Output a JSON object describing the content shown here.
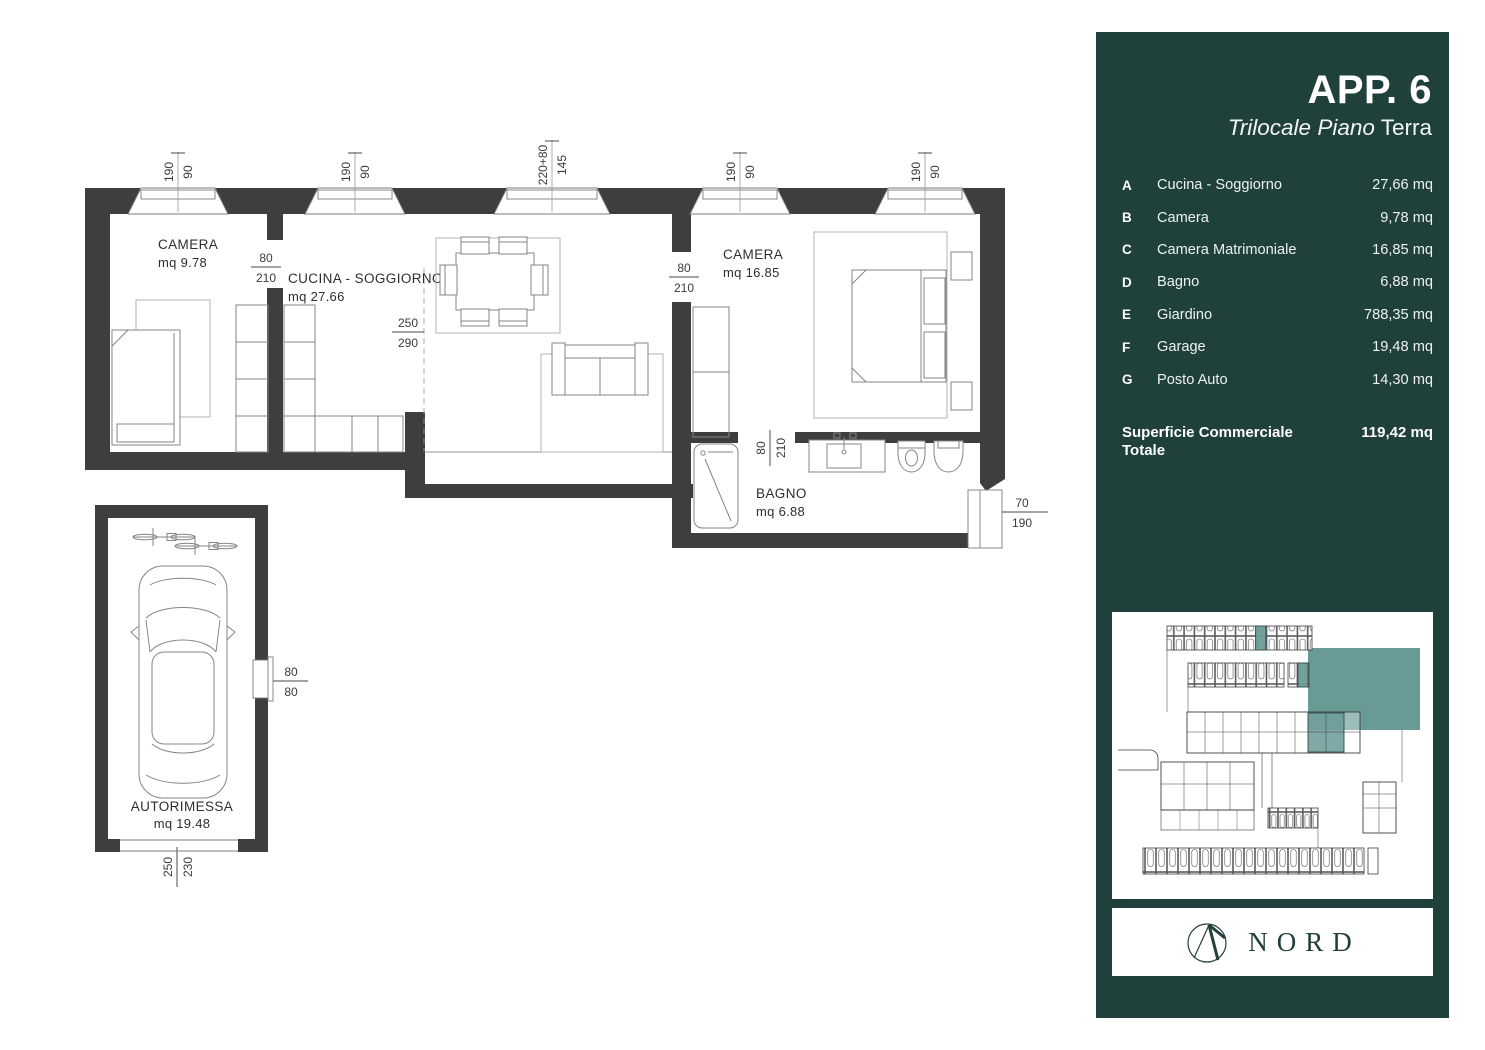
{
  "floorplan": {
    "rooms": {
      "camera1": {
        "name": "CAMERA",
        "area": "mq 9.78"
      },
      "cucina": {
        "name": "CUCINA - SOGGIORNO",
        "area": "mq 27.66"
      },
      "camera2": {
        "name": "CAMERA",
        "area": "mq 16.85"
      },
      "bagno": {
        "name": "BAGNO",
        "area": "mq 6.88"
      },
      "garage": {
        "name": "AUTORIMESSA",
        "area": "mq 19.48"
      }
    },
    "dimensions": {
      "window1": {
        "a": "190",
        "b": "90"
      },
      "window2": {
        "a": "190",
        "b": "90"
      },
      "window3": {
        "a": "220+80",
        "b": "145"
      },
      "window4": {
        "a": "190",
        "b": "90"
      },
      "window5": {
        "a": "190",
        "b": "90"
      },
      "door1": {
        "a": "80",
        "b": "210"
      },
      "door2": {
        "a": "80",
        "b": "210"
      },
      "door3": {
        "a": "80",
        "b": "210"
      },
      "ceiling": {
        "a": "250",
        "b": "290"
      },
      "bath_window": {
        "a": "70",
        "b": "190"
      },
      "garage_window": {
        "a": "80",
        "b": "80"
      },
      "garage_door": {
        "a": "250",
        "b": "230"
      }
    }
  },
  "panel": {
    "title": "APP. 6",
    "subtitle_italic": "Trilocale Piano",
    "subtitle_regular": "Terra",
    "rows": [
      {
        "key": "A",
        "label": "Cucina - Soggiorno",
        "value": "27,66 mq"
      },
      {
        "key": "B",
        "label": "Camera",
        "value": "9,78 mq"
      },
      {
        "key": "C",
        "label": "Camera Matrimoniale",
        "value": "16,85 mq"
      },
      {
        "key": "D",
        "label": "Bagno",
        "value": "6,88 mq"
      },
      {
        "key": "E",
        "label": "Giardino",
        "value": "788,35 mq"
      },
      {
        "key": "F",
        "label": "Garage",
        "value": "19,48 mq"
      },
      {
        "key": "G",
        "label": "Posto Auto",
        "value": "14,30 mq"
      }
    ],
    "total": {
      "label": "Superficie Commerciale Totale",
      "value": "119,42 mq"
    },
    "logo": {
      "text": "NORD",
      "mark": "compass-peak-icon"
    },
    "colors": {
      "panel_bg": "#20403C",
      "highlight": "#689A96",
      "wall": "#3C3E3F"
    }
  }
}
